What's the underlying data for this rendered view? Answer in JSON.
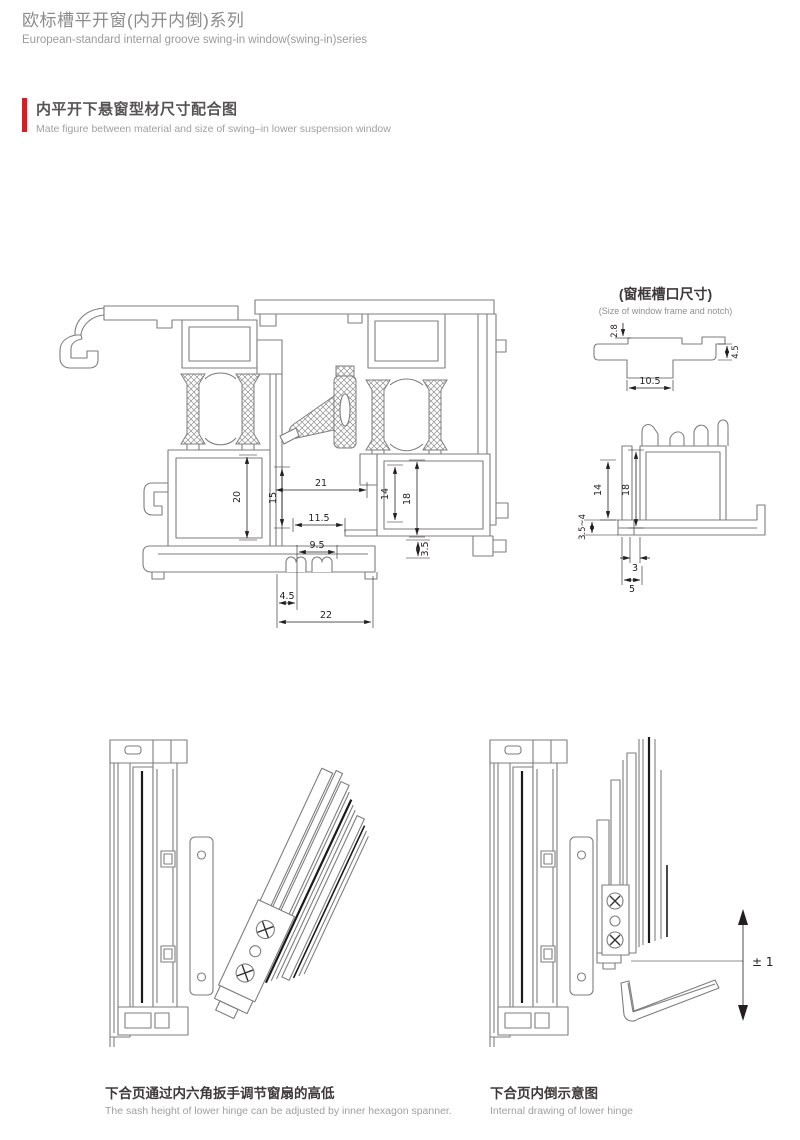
{
  "header": {
    "title_zh": "欧标槽平开窗(内开内倒)系列",
    "title_en": "European-standard internal groove swing-in window(swing-in)series"
  },
  "section": {
    "heading_zh": "内平开下悬窗型材尺寸配合图",
    "heading_en": "Mate figure between material and size of swing–in lower suspension window",
    "accent_color": "#cf2128"
  },
  "main_profile": {
    "dims": {
      "d20": "20",
      "d21": "21",
      "d15": "15",
      "d14": "14",
      "d18": "18",
      "d11_5": "11.5",
      "d9_5": "9.5",
      "d3_5": "3.5",
      "d4_5": "4.5",
      "d22": "22"
    }
  },
  "notch_detail": {
    "title_zh": "(窗框槽口尺寸)",
    "title_en": "(Size of window frame and notch)",
    "dims": {
      "d2_8": "2.8",
      "d4_5": "4.5",
      "d10_5": "10.5"
    }
  },
  "sash_detail": {
    "dims": {
      "d14": "14",
      "d18": "18",
      "d3_5_4": "3.5~4",
      "d3": "3",
      "d5": "5"
    }
  },
  "hinge_left": {
    "caption_zh": "下合页通过内六角扳手调节窗扇的高低",
    "caption_en": "The sash height of lower hinge can be adjusted by inner hexagon spanner."
  },
  "hinge_right": {
    "caption_zh": "下合页内倒示意图",
    "caption_en": "Internal drawing of lower hinge",
    "adjustment": "± 1"
  },
  "colors": {
    "accent": "#cf2128",
    "outline": "#7e7e7e",
    "dimension": "#231f20"
  }
}
